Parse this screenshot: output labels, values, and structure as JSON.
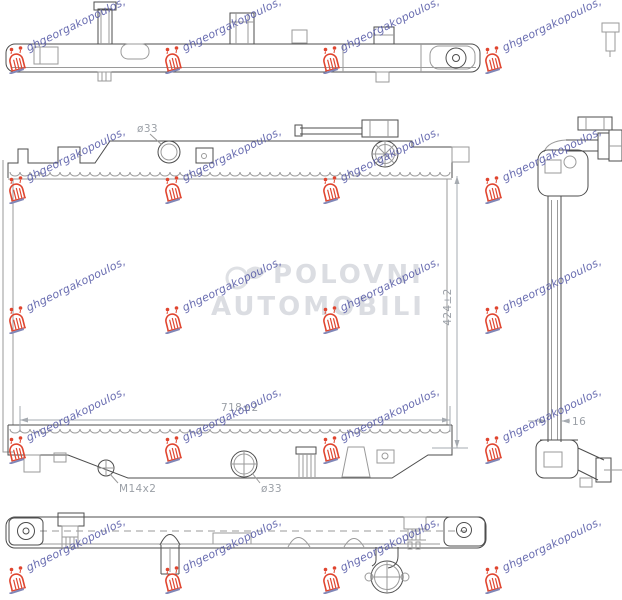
{
  "watermark": {
    "stamp_text": "ghgeorgakopoulos,",
    "stamp_text_color": "#5458a6",
    "logo_color": "#e0452f",
    "center_line1": "POLOVNI",
    "center_line2": "AUTOMOBILI"
  },
  "dimensions": {
    "top_inlet_diameter": "ø33",
    "core_height": "424±2",
    "core_width": "718±2",
    "drain_plug": "M14x2",
    "outlet_diameter": "ø33",
    "core_thickness": "16"
  }
}
